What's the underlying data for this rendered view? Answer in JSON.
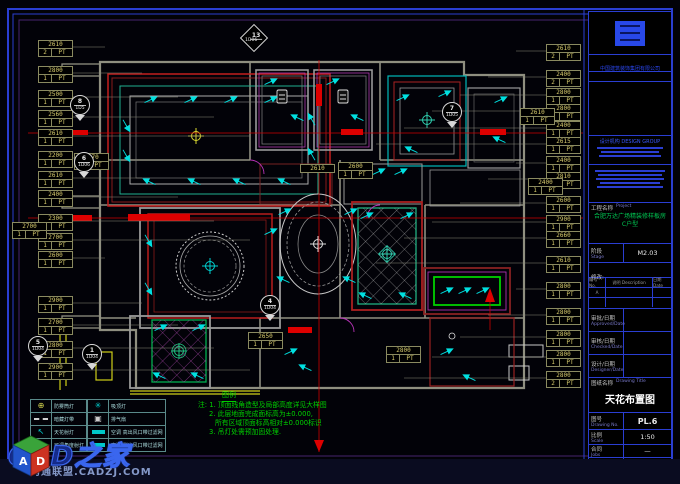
{
  "company": {
    "name": "中国建筑装饰集团有限公司"
  },
  "title_block": {
    "design_org": "设计机构 DESIGN GROUP",
    "project_label": "工程名称",
    "project_label_en": "Project",
    "project_name": "合肥万达广场精装修样板房",
    "project_name2": "C户型",
    "stage_label": "阶段",
    "stage_label_en": "Stage",
    "stage_value": "M2.03",
    "revision_label": "修改:",
    "rev_cols": [
      "编号 No.",
      "说明 Description",
      "日期 Date"
    ],
    "rev_row": "A",
    "approved_label": "审批/日期",
    "approved_en": "Approved/Date",
    "checked_label": "审核/日期",
    "checked_en": "Checked/Date",
    "designer_label": "设计/日期",
    "designer_en": "Designer/Date",
    "drawing_title_label": "图纸名称",
    "drawing_title_en": "Drawing Title",
    "drawing_title": "天花布置图",
    "drawing_no_label": "图号",
    "drawing_no_en": "Drawing No.",
    "drawing_no": "PL.6",
    "scale_label": "比例",
    "scale_en": "Scale",
    "scale_value": "1:50",
    "job_label": "合同",
    "job_en": "Jobs",
    "job_value": "—",
    "date_label": "日期",
    "date_en": "Date",
    "date_value": "2011.2"
  },
  "notes": {
    "legend_title": "图例",
    "lines": [
      "注: 1. 顶面线角造型及局部高度详见大样图",
      "2. 此层地面完成面标高为±0.000,",
      "所有区域顶面标高相对±0.000标识",
      "3. 吊灯处需预加固处理."
    ]
  },
  "legend": {
    "left_rows": [
      {
        "icon": "downlight",
        "label": "防雾筒灯"
      },
      {
        "icon": "strip",
        "label": "暗藏灯带"
      },
      {
        "icon": "spot",
        "label": "天花射灯"
      },
      {
        "icon": "spot",
        "label": "可调角度射灯"
      }
    ],
    "right_rows": [
      {
        "icon": "pendant",
        "label": "吸顶灯"
      },
      {
        "icon": "exhaust",
        "label": "排气扇"
      },
      {
        "icon": "vent",
        "label": "空调 高出风口带过滤网"
      },
      {
        "icon": "vent",
        "label": "空调 侧出风口带过滤网"
      }
    ]
  },
  "watermark": {
    "brand": "CAD之家",
    "url": "沟通联盟.CADZJ.COM",
    "cube": [
      "A",
      "D"
    ]
  },
  "plan": {
    "tags_left": [
      {
        "v": "2610",
        "f": "2",
        "y": 40
      },
      {
        "v": "2800",
        "f": "1",
        "y": 66
      },
      {
        "v": "2500",
        "f": "1",
        "y": 90
      },
      {
        "v": "2560",
        "f": "1",
        "y": 110
      },
      {
        "v": "2610",
        "f": "1",
        "y": 129
      },
      {
        "v": "2200",
        "f": "1",
        "y": 151
      },
      {
        "v": "2610",
        "f": "1",
        "y": 171
      },
      {
        "v": "2400",
        "f": "1",
        "y": 190
      },
      {
        "v": "2300",
        "f": "1",
        "y": 214
      },
      {
        "v": "2700",
        "f": "1",
        "y": 233
      },
      {
        "v": "2600",
        "f": "1",
        "y": 251
      },
      {
        "v": "2900",
        "f": "1",
        "y": 296
      },
      {
        "v": "2700",
        "f": "1",
        "y": 318
      },
      {
        "v": "2800",
        "f": "1",
        "y": 341
      },
      {
        "v": "2900",
        "f": "1",
        "y": 363
      }
    ],
    "tags_right": [
      {
        "v": "2610",
        "f": "2",
        "y": 44
      },
      {
        "v": "2400",
        "f": "2",
        "y": 70
      },
      {
        "v": "2800",
        "f": "1",
        "y": 88
      },
      {
        "v": "2800",
        "f": "1",
        "y": 104
      },
      {
        "v": "2400",
        "f": "1",
        "y": 121
      },
      {
        "v": "2615",
        "f": "1",
        "y": 137
      },
      {
        "v": "2400",
        "f": "1",
        "y": 156
      },
      {
        "v": "2810",
        "f": "1",
        "y": 172
      },
      {
        "v": "2600",
        "f": "1",
        "y": 196
      },
      {
        "v": "2900",
        "f": "1",
        "y": 215
      },
      {
        "v": "2660",
        "f": "1",
        "y": 231
      },
      {
        "v": "2610",
        "f": "1",
        "y": 256
      },
      {
        "v": "2800",
        "f": "1",
        "y": 282
      },
      {
        "v": "2800",
        "f": "1",
        "y": 308
      },
      {
        "v": "2800",
        "f": "1",
        "y": 330
      },
      {
        "v": "2800",
        "f": "1",
        "y": 350
      },
      {
        "v": "2800",
        "f": "2",
        "y": 371
      }
    ],
    "tags_inner": [
      {
        "v": "2770",
        "f": "1",
        "x": 74,
        "y": 153
      },
      {
        "v": "2610",
        "x": 300,
        "y": 164,
        "single": true
      },
      {
        "v": "2600",
        "f": "1",
        "x": 338,
        "y": 162
      },
      {
        "v": "2610",
        "f": "1",
        "x": 520,
        "y": 108
      },
      {
        "v": "2400",
        "f": "1",
        "x": 528,
        "y": 178
      },
      {
        "v": "2650",
        "f": "1",
        "x": 248,
        "y": 332
      },
      {
        "v": "2800",
        "f": "1",
        "x": 386,
        "y": 346
      },
      {
        "v": "2700",
        "f": "1",
        "x": 12,
        "y": 222
      }
    ],
    "markers": [
      {
        "n": "8",
        "c": "1D5",
        "x": 70,
        "y": 95,
        "shape": "circle"
      },
      {
        "n": "6",
        "c": "1D06",
        "x": 74,
        "y": 152,
        "shape": "circle"
      },
      {
        "n": "7",
        "c": "1D05",
        "x": 442,
        "y": 102,
        "shape": "circle"
      },
      {
        "n": "13",
        "c": "1D06",
        "x": 244,
        "y": 28,
        "shape": "diamond"
      },
      {
        "n": "5",
        "c": "1D04",
        "x": 28,
        "y": 336,
        "shape": "circle"
      },
      {
        "n": "1",
        "c": "1D04",
        "x": 82,
        "y": 344,
        "shape": "circle"
      },
      {
        "n": "4",
        "c": "1D04",
        "x": 260,
        "y": 295,
        "shape": "circle"
      }
    ],
    "spotlights": [
      [
        150,
        100,
        -25
      ],
      [
        190,
        100,
        -25
      ],
      [
        230,
        100,
        -25
      ],
      [
        270,
        100,
        -25
      ],
      [
        150,
        182,
        205
      ],
      [
        195,
        182,
        205
      ],
      [
        240,
        182,
        205
      ],
      [
        285,
        182,
        205
      ],
      [
        126,
        125,
        60
      ],
      [
        126,
        155,
        60
      ],
      [
        312,
        120,
        240
      ],
      [
        312,
        155,
        240
      ],
      [
        270,
        82,
        -25
      ],
      [
        298,
        118,
        205
      ],
      [
        332,
        82,
        -25
      ],
      [
        358,
        118,
        205
      ],
      [
        402,
        98,
        -25
      ],
      [
        444,
        94,
        -25
      ],
      [
        412,
        150,
        205
      ],
      [
        500,
        100,
        -25
      ],
      [
        500,
        140,
        205
      ],
      [
        354,
        172,
        -25
      ],
      [
        378,
        172,
        -25
      ],
      [
        400,
        172,
        -25
      ],
      [
        148,
        240,
        60
      ],
      [
        148,
        288,
        60
      ],
      [
        270,
        232,
        -25
      ],
      [
        284,
        212,
        -25
      ],
      [
        350,
        212,
        -25
      ],
      [
        284,
        280,
        205
      ],
      [
        350,
        280,
        205
      ],
      [
        366,
        216,
        -25
      ],
      [
        406,
        216,
        -25
      ],
      [
        366,
        296,
        205
      ],
      [
        406,
        296,
        205
      ],
      [
        446,
        291,
        -25
      ],
      [
        464,
        291,
        -25
      ],
      [
        482,
        291,
        -25
      ],
      [
        160,
        328,
        -25
      ],
      [
        198,
        328,
        -25
      ],
      [
        160,
        376,
        205
      ],
      [
        198,
        376,
        205
      ],
      [
        290,
        352,
        -25
      ],
      [
        306,
        368,
        205
      ],
      [
        446,
        352,
        -25
      ],
      [
        470,
        378,
        205
      ]
    ]
  }
}
